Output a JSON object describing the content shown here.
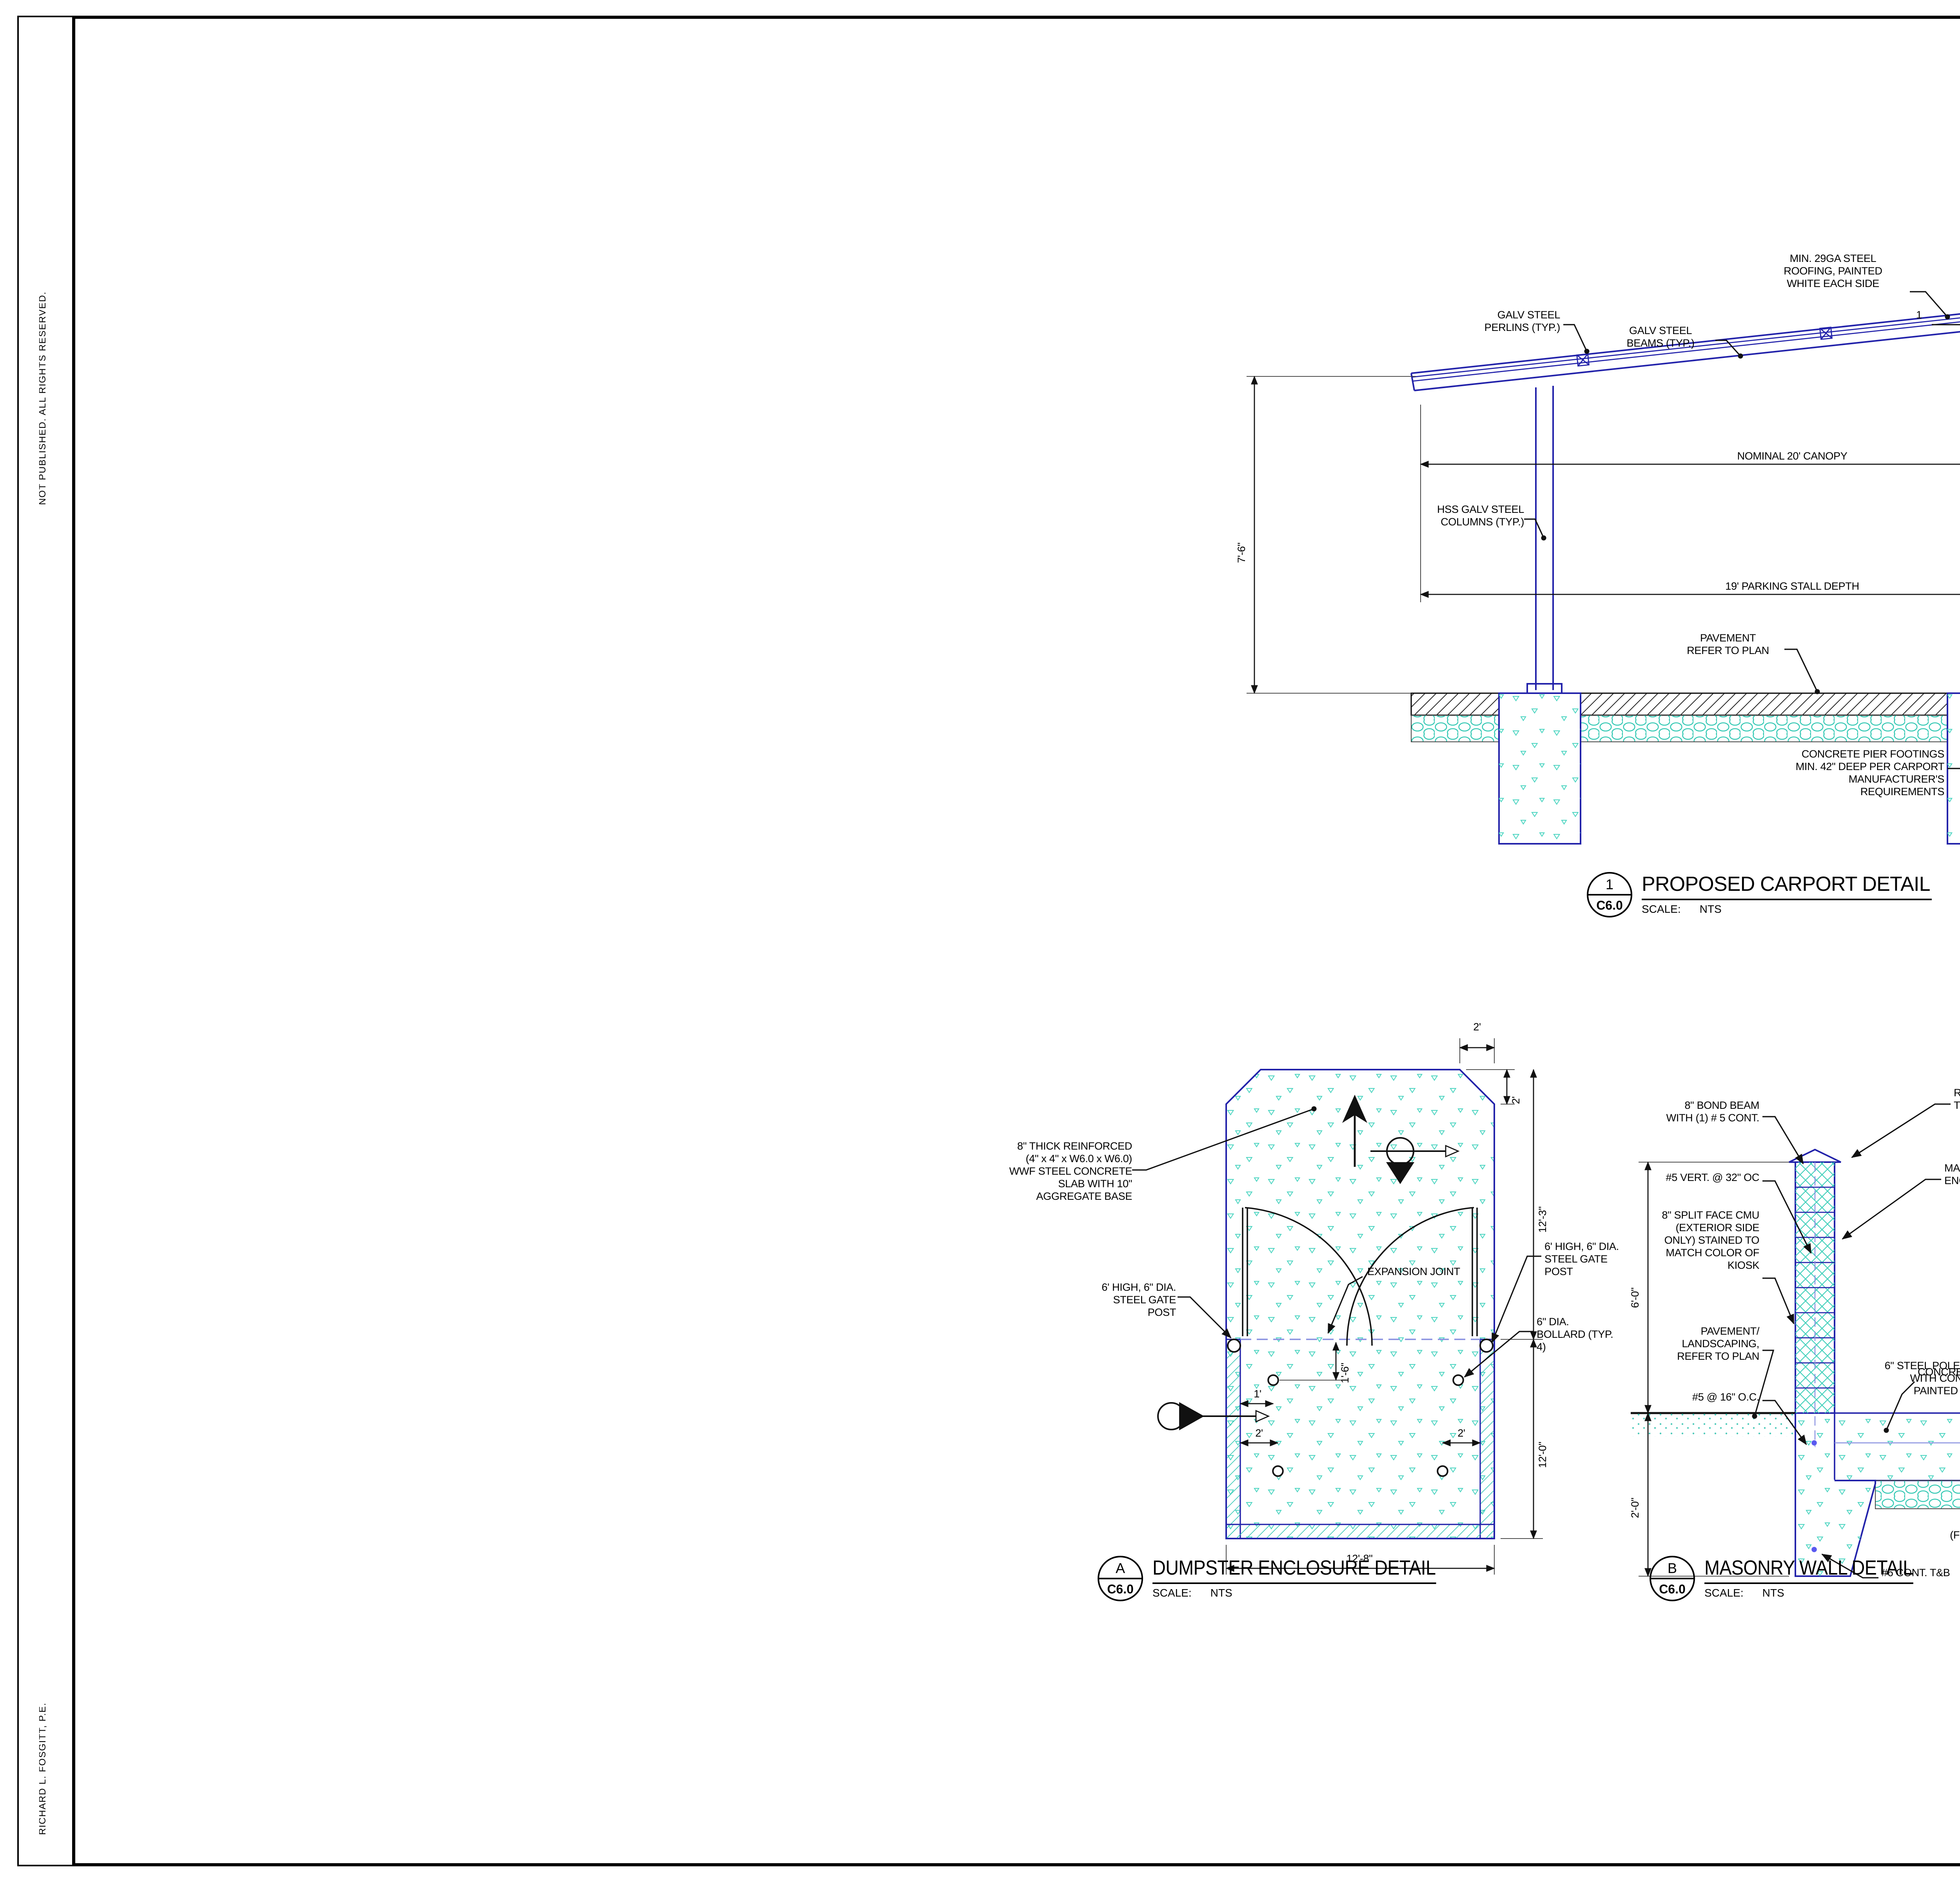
{
  "colors": {
    "line_blue": "#2222aa",
    "hatch_teal": "#2fc7b2",
    "ink": "#111111"
  },
  "sheet": {
    "margin_top_note": "NOT PUBLISHED.  ALL RIGHTS RESERVED.",
    "margin_bottom_note": "RICHARD L. FOSGITT, P.E."
  },
  "carport": {
    "ref_number": "1",
    "ref_sheet": "C6.0",
    "title": "PROPOSED CARPORT DETAIL",
    "scale_label": "SCALE:",
    "scale_value": "NTS",
    "labels": {
      "roofing": "MIN. 29GA STEEL\nROOFING, PAINTED\nWHITE EACH SIDE",
      "perlins": "GALV STEEL\nPERLINS (TYP.)",
      "beams": "GALV STEEL\nBEAMS (TYP.)",
      "slope_rise": "1",
      "slope_run": "12",
      "columns": "HSS GALV STEEL\nCOLUMNS (TYP.)",
      "pavement": "PAVEMENT\nREFER TO PLAN",
      "rounded_top": "ROUNDED CONCRETE\nTOP PAINTED BROWN",
      "bond_beam": "8\" BOND BEAM\nWITH (1) # 5 CONT.",
      "vert_bars": "#5 VERT. @ 32\" OC",
      "cmu": "8\" SPLIT FACE CMU\n(BOTH SIDES)\nSTAINED BROWN",
      "bond_beam_courses": "8\" BOND BEAM\nWITH (1) # 5 CONT\nEVERY 4 COURSES.",
      "pier_footings": "CONCRETE PIER FOOTINGS\nMIN. 42\" DEEP PER CARPORT\nMANUFACTURER'S\nREQUIREMENTS",
      "wall_footing": "16\" X 20\"\nFOOTING WITH\n3 - #5 CONT."
    },
    "dims": {
      "canopy": "NOMINAL 20' CANOPY",
      "stall": "19' PARKING STALL DEPTH",
      "height": "7'-6\"",
      "wall_height": "6'-0\""
    }
  },
  "dumpster": {
    "ref_number": "A",
    "ref_sheet": "C6.0",
    "title": "DUMPSTER ENCLOSURE DETAIL",
    "scale_label": "SCALE:",
    "scale_value": "NTS",
    "labels": {
      "slab": "8\" THICK REINFORCED\n(4\" x 4\" x W6.0 x W6.0)\nWWF STEEL CONCRETE\nSLAB WITH 10\"\nAGGREGATE BASE",
      "post_left": "6' HIGH, 6\" DIA.\nSTEEL GATE\nPOST",
      "post_right": "6' HIGH, 6\" DIA.\nSTEEL GATE\nPOST",
      "expansion": "EXPANSION JOINT",
      "bollard": "6\" DIA.\nBOLLARD (TYP.\n4)"
    },
    "dims": {
      "top_w": "2'",
      "top_h": "2'",
      "right_upper": "12'-3\"",
      "right_lower": "12'-0\"",
      "bottom": "12'-8\"",
      "gate_inset": "1'",
      "gate_down": "1'-6\"",
      "bottom_left": "2'",
      "bottom_right": "2'"
    }
  },
  "masonry": {
    "ref_number": "B",
    "ref_sheet": "C6.0",
    "title": "MASONRY WALL DETAIL",
    "scale_label": "SCALE:",
    "scale_value": "NTS",
    "labels": {
      "bond_beam": "8\" BOND BEAM\nWITH (1) # 5 CONT.",
      "vert_bars": "#5 VERT. @ 32\" OC",
      "cmu": "8\" SPLIT FACE CMU\n(EXTERIOR SIDE\nONLY) STAINED TO\nMATCH COLOR OF\nKIOSK",
      "pavement": "PAVEMENT/\nLANDSCAPING,\nREFER TO PLAN",
      "footing_bars": "#5 @ 16\" O.C.",
      "rounded_top": "ROUNDED CONCRETE\nTOP PAINTED BROWN",
      "wall": "MASONRY\nENCLOSURE WALL",
      "concrete": "CONCRETE",
      "cont_tb": "#6 CONT. T&B"
    },
    "dims": {
      "height": "6'-0\"",
      "depth": "2'-0\""
    }
  },
  "gate": {
    "ref_number": "C",
    "ref_sheet": "C6.0",
    "title": "DUMPSTER ENCLOSURE GATE DETAIL",
    "scale_label": "SCALE:",
    "scale_value": "NTS",
    "labels": {
      "hinges": "PROVIDE (3) HEAVY DUTY HINGES\nFRO EACH GATE LEAF",
      "angles": "2\" x 2\" x 5/16\" METAL ANGLES MITER CORNERS AND COPE\nANGLE BRACING. FLUSH ALL WEEDS SMOOTH. PRIME &\nPAINT.",
      "decking": "5/4\" x 6'-0\" VERTICAL PRESSURE\nTREATED DECKING ATTACHED TO\nMETAL ANGLE FRAME ON 6\" Ø x 6'-0\"\nGALVANIZED GATE POST.",
      "sag_rod": "DIAGONAL SAG ROD",
      "barn_stop": "PROVIDE COMMERCIAL GRADE\nBARN STOP AND LOCKING\nHARDWARE",
      "pipe_clamps": "PIPE CLAMPS SCREWED TO GATE\nWITH WASHERS SPACERS TO\nFACILITATE SLIDING",
      "pipe_sleeve": "PIPE SLEEVE SET IN CONCRETE\nTO RECEIVE BARN GATE STOP 4\"\nLONG, EXTEND 1/4\" ABOVE\nCONCRETE",
      "aggregate": "10\" AGGREGATE BASE",
      "wwf": "4\" x 4\" x W6.0 x W6.0 WWF STEEL",
      "encase": "ENCASE PIPE WITH\nCONCRETE AFTER PIPE\nIS SET",
      "place_footing": "PLACE PIPE FOOTING\nINTEGRAL WITH WALL\nFOOTING",
      "footing_beyond": "(FOOTING BEYOND)",
      "steel_pole": "6\" STEEL POLE, FILLED\nWITH CONCRETE,\nPAINTED BROWN",
      "x_left": "X",
      "x_right": "X"
    }
  },
  "titleblock": {
    "supervision": "PREPARED UNDER THE\nSUPERVISION OF:",
    "seal": {
      "top_arc": "STATE OF MICHIGAN",
      "bottom_arc": "LICENSED PROFESSIONAL ENGINEER",
      "name1": "RICHARD L.",
      "name2": "FOSGITT",
      "title": "ENGINEER",
      "no_label": "No.",
      "number": "43189",
      "star": "★"
    },
    "project_log": {
      "header": "PROJECT LOG",
      "entries": [
        {
          "date": "04-17-19",
          "desc": "PRELIMINARY LAYOUT FOR REVIEW"
        },
        {
          "date": "",
          "desc": "UPDATED SITE PLAN REVIEW"
        },
        {
          "date": "04-04-22",
          "desc": "UPDATED SITE PLAN REVIEW"
        },
        {
          "date": "10-10-22",
          "desc": "REVISED LAYOUT"
        }
      ]
    },
    "fields": {
      "file_label": "FILE #:",
      "file_value": "OVERALL",
      "mgr_label": "PROJ MGR:",
      "mgr_value": "RLF",
      "design_label": "DESIGN BY:",
      "design_value": "RLF",
      "drawn_label": "DRAWN BY:",
      "drawn_value": "RLF",
      "checked_label": "CHECKED BY:",
      "checked_value": "",
      "scale_label": "SCALE:",
      "scale_value": "NONE\nNONE",
      "sheet_label": "SHEET:",
      "sheet_value": "1 OF 1"
    },
    "firm": {
      "name": "REDRIDGE ENGINEERING, LLC",
      "address": "2807 HIGHBROOK DRIVE, MIDLAND, MI 48642",
      "phone_email": "989-513-4058  RFOSGITT@REDRIDGE-ENG.COM"
    },
    "confidential": {
      "heading": "CONFIDENTIAL:",
      "body": "Drawings contain confidential, proprietary,\nand copyrighted information.\nReproduction or distribution of drawings\nor any information contained in these\ndocuments is prohibited without the\nwritten approval of the Owner."
    },
    "client": {
      "line1": "LANGE VIEW TOWNHOUSES",
      "line2": "STRATEGIC PROPERTY SERVICES, LLC",
      "addr1": "4080 LIVERNOIS ROAD",
      "addr2": "CITY OF TROY",
      "addr3": "OAKLAND COUNTY, MICHIGAN"
    },
    "sheet_title": "SITE DETAILS 1",
    "sheet_number": "C6.0",
    "project_number": "180401"
  },
  "call811": {
    "number": "811",
    "reg": "®",
    "line1": "Know what's below.",
    "call": "Call",
    "line2": " before you dig."
  }
}
